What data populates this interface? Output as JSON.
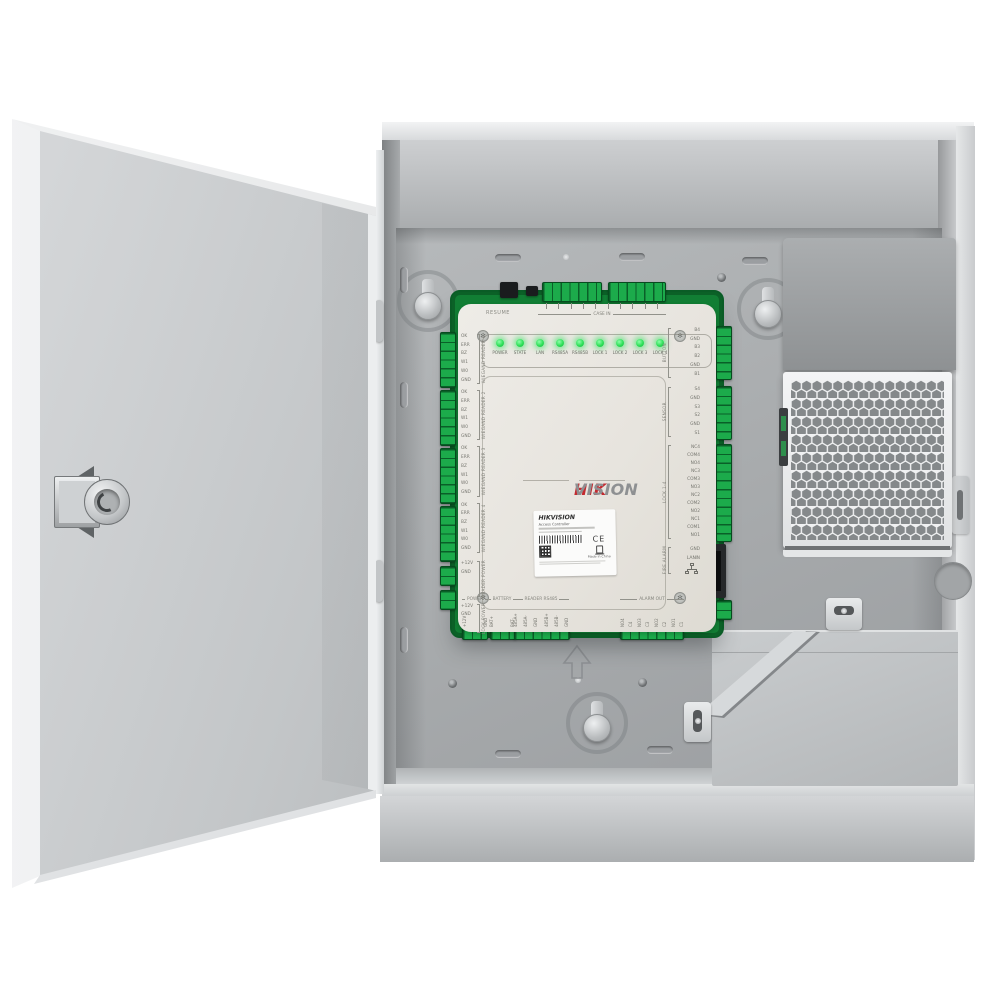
{
  "image_type": "product-photo",
  "subject": "Access controller board mounted inside an open metal enclosure with power supply and battery compartment",
  "colors": {
    "brand_red": "#c32a30",
    "brand_gray": "#8e9092",
    "pcb_green": "#1cab4b",
    "led_green": "#2ddf58",
    "enclosure_gray": "#b0b3b5"
  },
  "brand": {
    "hik": "HIK",
    "vision": "VISION"
  },
  "board": {
    "resume": "RESUME",
    "case_in": "CASE IN",
    "leds": [
      "POWER",
      "STATE",
      "LAN",
      "RS485A",
      "RS485B",
      "LOCK 1",
      "LOCK 2",
      "LOCK 3",
      "LOCK 4"
    ],
    "left_groups": [
      {
        "name": "WIEGAND READER 1",
        "pins": [
          "OK",
          "ERR",
          "BZ",
          "W1",
          "W0",
          "GND"
        ]
      },
      {
        "name": "WIEGAND READER 2",
        "pins": [
          "OK",
          "ERR",
          "BZ",
          "W1",
          "W0",
          "GND"
        ]
      },
      {
        "name": "WIEGAND READER 3",
        "pins": [
          "OK",
          "ERR",
          "BZ",
          "W1",
          "W0",
          "GND"
        ]
      },
      {
        "name": "WIEGAND READER 4",
        "pins": [
          "OK",
          "ERR",
          "BZ",
          "W1",
          "W0",
          "GND"
        ]
      },
      {
        "name": "READER POWER",
        "pins": [
          "+12V",
          "GND"
        ]
      },
      {
        "name": "LOCK POWER",
        "pins": [
          "+12V",
          "GND"
        ]
      }
    ],
    "right_groups": [
      {
        "name": "BUTTON",
        "pins": [
          "B4",
          "GND",
          "B3",
          "B2",
          "GND",
          "B1"
        ]
      },
      {
        "name": "SENSOR",
        "pins": [
          "S4",
          "GND",
          "S3",
          "S2",
          "GND",
          "S1"
        ]
      },
      {
        "name": "LOCK 1-4",
        "pins": [
          "NC4",
          "COM4",
          "NO4",
          "NC3",
          "COM3",
          "NO3",
          "NC2",
          "COM2",
          "NO2",
          "NC1",
          "COM1",
          "NO1"
        ]
      },
      {
        "name": "FIRE ALARM",
        "pins": [
          "GND",
          "IN"
        ]
      }
    ],
    "bottom_groups": [
      {
        "name": "POWER",
        "pins": [
          "+12V",
          "GND"
        ]
      },
      {
        "name": "BATTERY",
        "pins": [
          "BAT+",
          "BAT-"
        ]
      },
      {
        "name": "READER RS485",
        "pins": [
          "485A+",
          "485A-",
          "GND",
          "485B+",
          "485B-",
          "GND"
        ]
      },
      {
        "name": "ALARM OUT",
        "pins": [
          "NO4",
          "C4",
          "NO3",
          "C3",
          "NO2",
          "C2",
          "NO1",
          "C1"
        ]
      }
    ],
    "lan": "LAN",
    "label": {
      "brand": "HIKVISION",
      "product": "Access Controller",
      "ce": "CE",
      "made_in": "Made in China"
    }
  }
}
